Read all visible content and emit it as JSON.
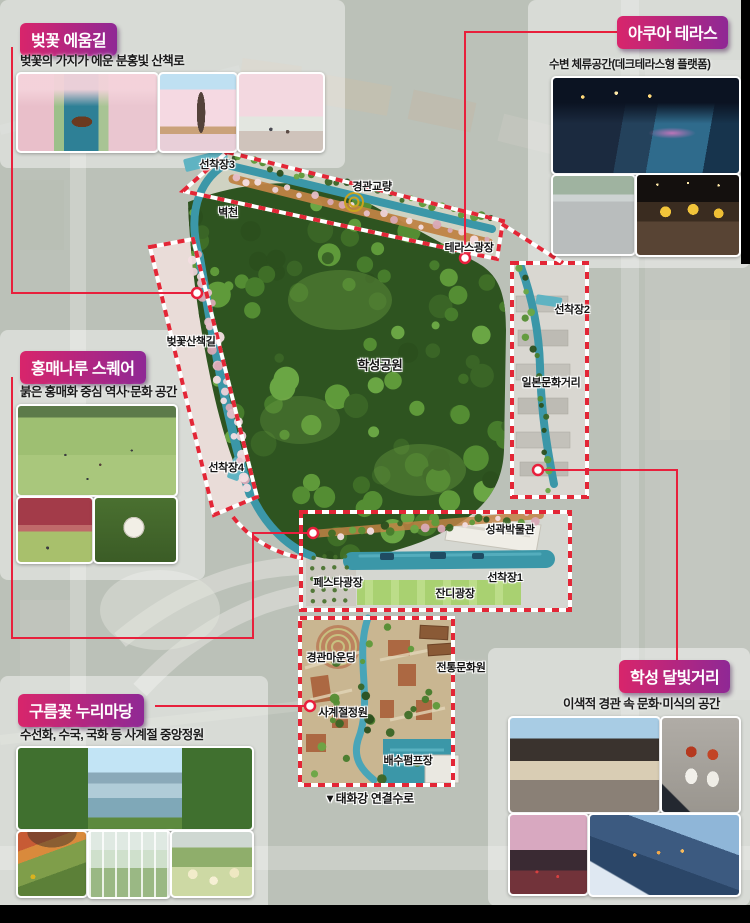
{
  "colors": {
    "accent_red": "#e8203c",
    "title_gradient_start": "#d8256b",
    "title_gradient_end": "#8f2895",
    "canal_teal": "#3b97a8",
    "forest_green": "#2e5420"
  },
  "cards": {
    "cherry_path": {
      "title": "벚꽃 에움길",
      "description": "벚꽃의 가지가 에운 분홍빛 산책로"
    },
    "aqua_terrace": {
      "title": "아쿠아 테라스",
      "description": "수변 체류공간(데크테라스형 플랫폼)"
    },
    "hongmae_square": {
      "title": "홍매나루 스퀘어",
      "description": "붉은 홍매화 중심 역사·문화 공간"
    },
    "cloud_flower_yard": {
      "title": "구름꽃 누리마당",
      "description": "수선화, 수국, 국화 등 사계절 중앙정원"
    },
    "moonlight_street": {
      "title": "학성 달빛거리",
      "description": "이색적 경관 속 문화·미식의 공간"
    }
  },
  "map": {
    "labels": [
      {
        "text": "선착장3"
      },
      {
        "text": "경관교량"
      },
      {
        "text": "벽천"
      },
      {
        "text": "테라스광장"
      },
      {
        "text": "선착장2"
      },
      {
        "text": "벚꽃산책길"
      },
      {
        "text": "학성공원"
      },
      {
        "text": "일본문화거리"
      },
      {
        "text": "선착장4"
      },
      {
        "text": "성곽박물관"
      },
      {
        "text": "페스타광장"
      },
      {
        "text": "선착장1"
      },
      {
        "text": "잔디광장"
      },
      {
        "text": "경관마운딩"
      },
      {
        "text": "전통문화원"
      },
      {
        "text": "사계절정원"
      },
      {
        "text": "배수펌프장"
      },
      {
        "text": "▼태화강 연결수로"
      }
    ]
  }
}
